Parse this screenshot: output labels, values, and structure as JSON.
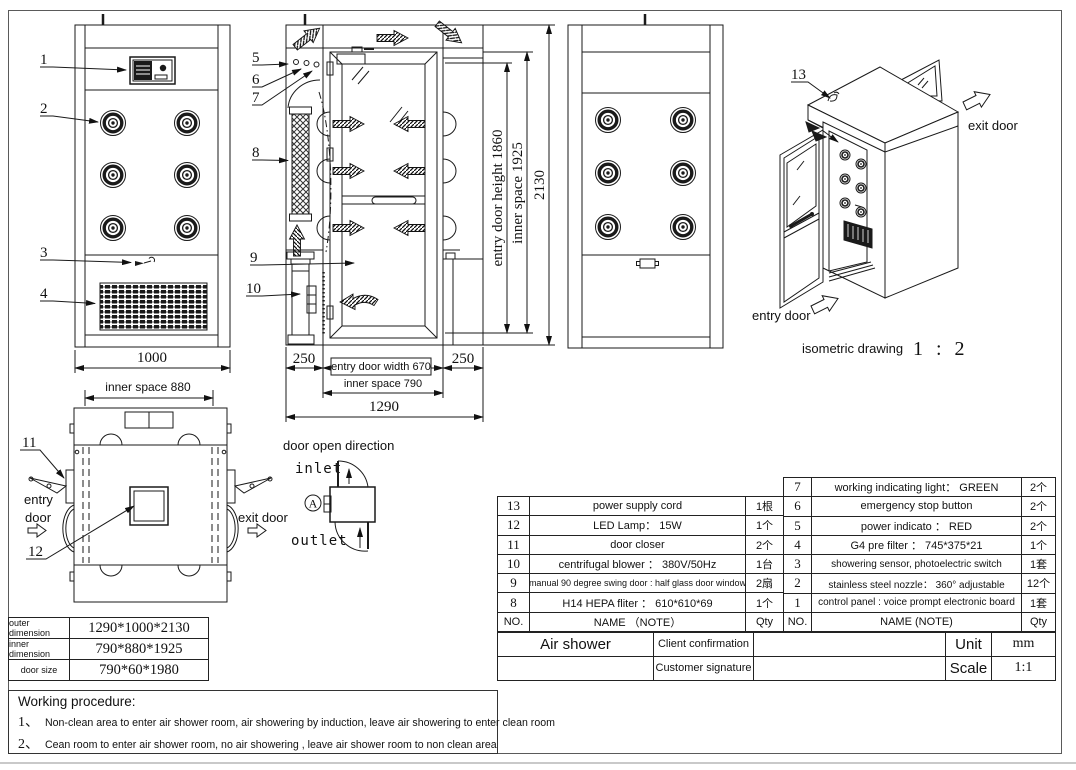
{
  "views": {
    "front": {
      "callouts": [
        "1",
        "2",
        "3",
        "4"
      ],
      "dim_width": "1000"
    },
    "side": {
      "callouts": [
        "5",
        "6",
        "7",
        "8",
        "9",
        "10"
      ],
      "dim_door_height": "entry door height 1860",
      "dim_inner_height": "inner space 1925",
      "dim_total_height": "2130",
      "dim_left": "250",
      "dim_right": "250",
      "dim_door_width": "entry door width 670",
      "dim_inner_width": "inner space 790",
      "dim_total_width": "1290"
    },
    "top": {
      "callouts": [
        "11",
        "12"
      ],
      "dim_inner": "inner space 880",
      "entry_line1": "entry",
      "entry_line2": "door",
      "exit_label": "exit door"
    },
    "door_direction": {
      "title": "door open direction",
      "inlet": "inlet",
      "outlet": "outlet",
      "marker": "A"
    },
    "isometric": {
      "callout": "13",
      "entry_label": "entry door",
      "exit_label": "exit door",
      "caption": "isometric drawing",
      "scale": "1 : 2"
    }
  },
  "dimension_table": {
    "rows": [
      {
        "label": "outer dimension",
        "value": "1290*1000*2130"
      },
      {
        "label": "inner dimension",
        "value": "790*880*1925"
      },
      {
        "label": "door size",
        "value": "790*60*1980"
      }
    ]
  },
  "parts_table_left": {
    "header": {
      "no": "NO.",
      "name": "NAME （NOTE）",
      "qty": "Qty"
    },
    "rows": [
      {
        "no": "13",
        "name": "power supply cord",
        "qty": "1根"
      },
      {
        "no": "12",
        "name": "LED Lamp： 15W",
        "qty": "1个"
      },
      {
        "no": "11",
        "name": "door closer",
        "qty": "2个"
      },
      {
        "no": "10",
        "name": "centrifugal blower ： 380V/50Hz",
        "qty": "1台"
      },
      {
        "no": "9",
        "name": "manual 90 degree swing door : half glass door window",
        "qty": "2扇"
      },
      {
        "no": "8",
        "name": "H14 HEPA fliter ： 610*610*69",
        "qty": "1个"
      }
    ]
  },
  "parts_table_right": {
    "header": {
      "no": "NO.",
      "name": "NAME (NOTE)",
      "qty": "Qty"
    },
    "rows": [
      {
        "no": "7",
        "name": "working indicating light： GREEN",
        "qty": "2个"
      },
      {
        "no": "6",
        "name": "emergency stop button",
        "qty": "2个"
      },
      {
        "no": "5",
        "name": "power indicato ： RED",
        "qty": "2个"
      },
      {
        "no": "4",
        "name": "G4 pre filter ： 745*375*21",
        "qty": "1个"
      },
      {
        "no": "3",
        "name": "showering sensor, photoelectric switch",
        "qty": "1套"
      },
      {
        "no": "2",
        "name": "stainless steel nozzle： 360° adjustable",
        "qty": "12个"
      },
      {
        "no": "1",
        "name": "control panel : voice prompt electronic board",
        "qty": "1套"
      }
    ]
  },
  "title_block": {
    "product": "Air shower",
    "client_label": "Client confirmation",
    "signature_label": "Customer signature",
    "unit_label": "Unit",
    "unit_value": "mm",
    "scale_label": "Scale",
    "scale_value": "1:1"
  },
  "working_procedure": {
    "title": "Working procedure:",
    "items": [
      {
        "no": "1、",
        "text": "Non-clean area to enter air shower room, air showering by induction, leave air showering to enter clean room"
      },
      {
        "no": "2、",
        "text": "Cean room to enter air shower room, no air showering , leave air shower room to non clean area"
      }
    ]
  }
}
